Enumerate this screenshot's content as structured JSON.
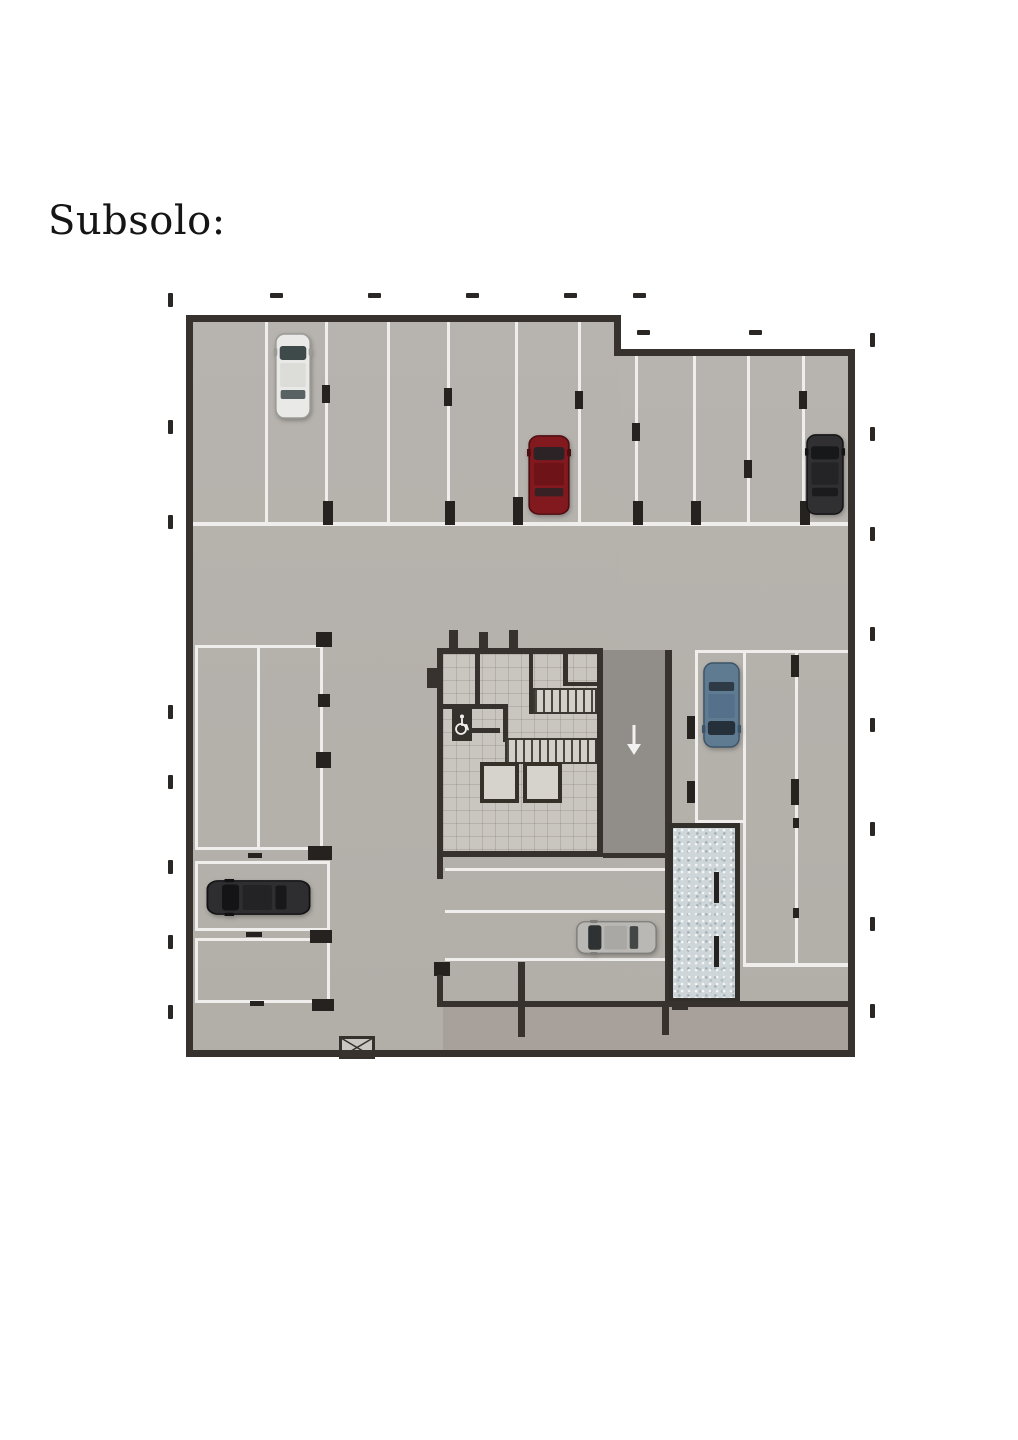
{
  "page": {
    "title": "Subsolo:"
  },
  "plan": {
    "type": "basement-parking-floor-plan",
    "colors": {
      "floor": "#b5b1ac",
      "wall": "#37322d",
      "stall_line": "#efeeec",
      "ramp_floor": "#918d89",
      "core_floor": "#c9c5bf",
      "lower_room_floor": "#a8a19b",
      "gravel": "#cfd6d9",
      "tick": "#2b2724",
      "white_line": "#efeeec"
    },
    "icons": [
      {
        "name": "accessible-icon",
        "meaning": "wheelchair-accessible WC in core"
      },
      {
        "name": "ramp-down-arrow-icon",
        "glyph": "↓",
        "meaning": "ramp down direction"
      },
      {
        "name": "cross-box-icon",
        "meaning": "crossed shaft/void marker on bottom wall"
      }
    ],
    "cars": [
      {
        "id": "white-car",
        "body": "#e9e9e7",
        "roof": "#dcdcd9",
        "glass": "#3e4a4a",
        "trim": "#9a9a96",
        "x": 106,
        "y": 47,
        "w": 38,
        "h": 88,
        "dir": "up"
      },
      {
        "id": "red-car",
        "body": "#82191f",
        "roof": "#6e1317",
        "glass": "#2c2326",
        "trim": "#4d0e12",
        "x": 359,
        "y": 149,
        "w": 44,
        "h": 82,
        "dir": "up"
      },
      {
        "id": "black-car",
        "body": "#303032",
        "roof": "#242427",
        "glass": "#17181a",
        "trim": "#141415",
        "x": 637,
        "y": 148,
        "w": 40,
        "h": 83,
        "dir": "up"
      },
      {
        "id": "blue-car",
        "body": "#5e7b92",
        "roof": "#54708a",
        "glass": "#26303a",
        "trim": "#3c5468",
        "x": 534,
        "y": 376,
        "w": 39,
        "h": 88,
        "dir": "down"
      },
      {
        "id": "dark-car",
        "body": "#2e2d2f",
        "roof": "#232224",
        "glass": "#141416",
        "trim": "#111113",
        "x": 37,
        "y": 594,
        "w": 107,
        "h": 37,
        "dir": "left"
      },
      {
        "id": "silver-car",
        "body": "#b9b8b5",
        "roof": "#a9a8a5",
        "glass": "#2e3233",
        "trim": "#7e7d7a",
        "x": 407,
        "y": 635,
        "w": 83,
        "h": 35,
        "dir": "left"
      }
    ],
    "ticks": {
      "top": {
        "y": 8,
        "xs": [
          102,
          200,
          298,
          396,
          465
        ]
      },
      "inner": {
        "y": 45,
        "xs": [
          469,
          581
        ]
      },
      "left": {
        "x": 0,
        "ys": [
          8,
          135,
          230,
          420,
          490,
          575,
          650,
          720
        ]
      },
      "right": {
        "x": 702,
        "ys": [
          48,
          142,
          242,
          342,
          433,
          537,
          632,
          719
        ]
      }
    }
  }
}
